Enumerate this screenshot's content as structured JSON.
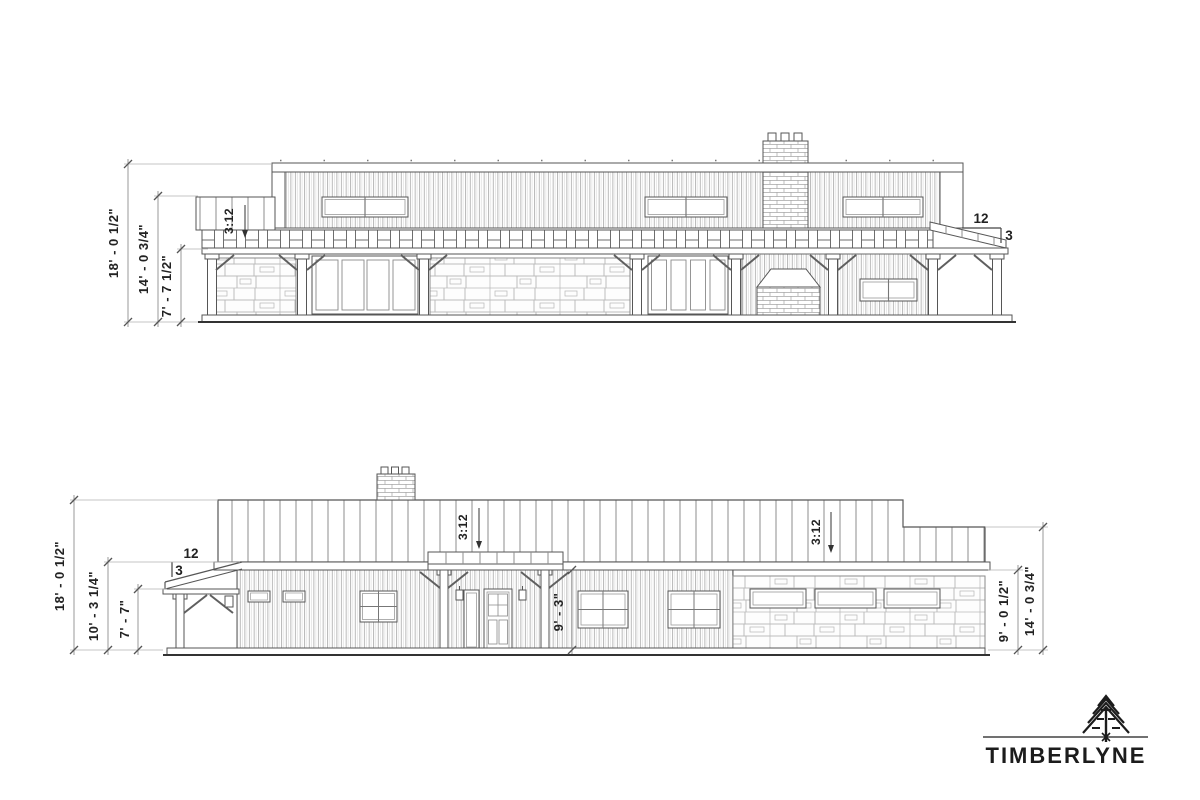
{
  "colors": {
    "background": "#ffffff",
    "linework": "#565656",
    "dimension_text": "#222222",
    "logo": "#1a1a1a"
  },
  "top_elevation": {
    "dims_left": [
      {
        "label": "18' - 0 1/2\""
      },
      {
        "label": "14' - 0 3/4\""
      },
      {
        "label": "7' - 7 1/2\""
      }
    ],
    "roof_slope_label": "3:12",
    "slope_triangle": {
      "run": "12",
      "rise": "3"
    }
  },
  "bottom_elevation": {
    "dims_left": [
      {
        "label": "18' - 0 1/2\""
      },
      {
        "label": "10' - 3 1/4\""
      },
      {
        "label": "7' - 7\""
      }
    ],
    "dim_entry_wall": {
      "label": "9' - 3\""
    },
    "dims_right": [
      {
        "label": "9' - 0 1/2\""
      },
      {
        "label": "14' - 0 3/4\""
      }
    ],
    "roof_slope_labels": [
      {
        "label": "3:12"
      },
      {
        "label": "3:12"
      }
    ],
    "slope_triangle": {
      "run": "12",
      "rise": "3"
    }
  },
  "logo": {
    "brand": "TIMBERLYNE"
  }
}
